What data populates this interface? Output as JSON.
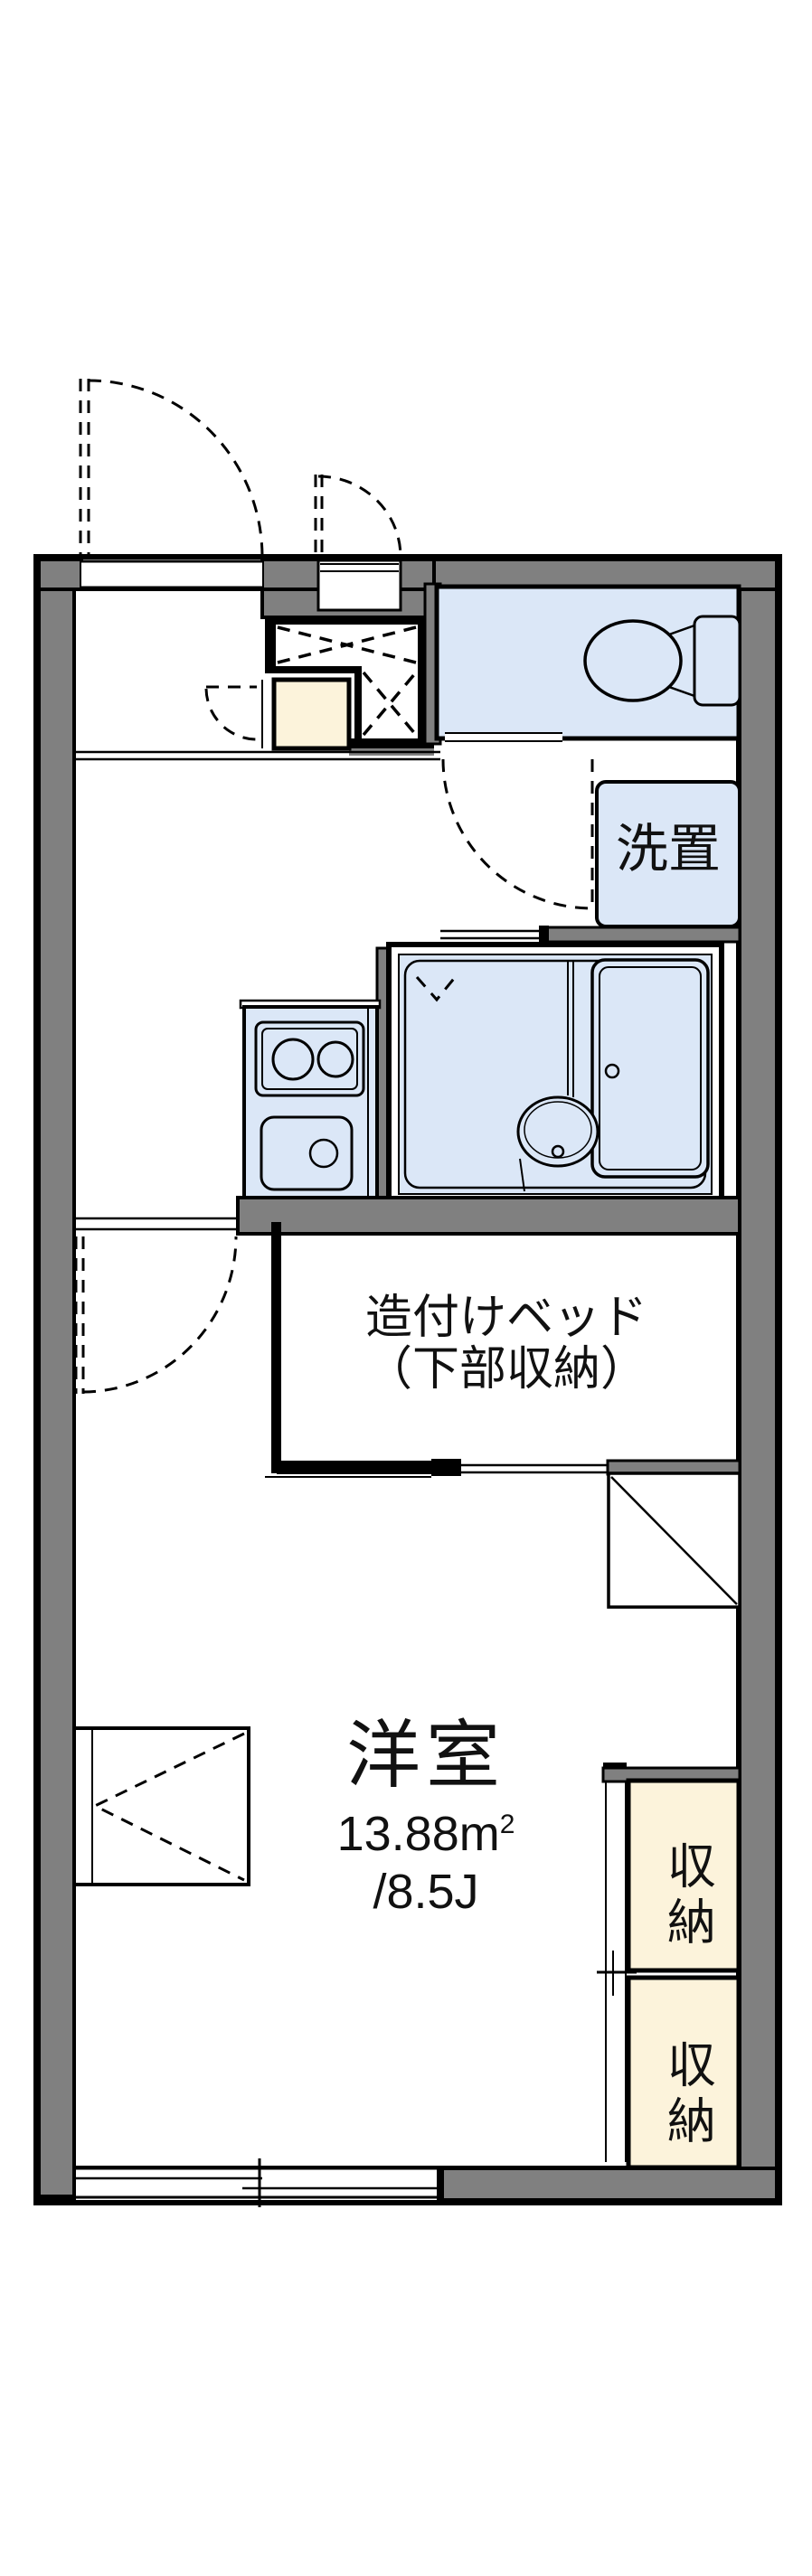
{
  "title": "Japanese apartment floor plan",
  "colors": {
    "wall_color": "#808080",
    "line_color": "#000000",
    "room_color": "#dbe7f7",
    "cream_color": "#fcf3db",
    "bg_color": "#ffffff",
    "text_color": "#111111"
  },
  "labels": {
    "laundry": "洗置",
    "bed_line1": "造付けベッド",
    "bed_line2": "（下部収納）",
    "room_name": "洋室",
    "room_area_main": "13.88m",
    "room_area_exp": "2",
    "room_size_jo": "/8.5J",
    "storage": [
      "収納",
      "収納"
    ]
  }
}
